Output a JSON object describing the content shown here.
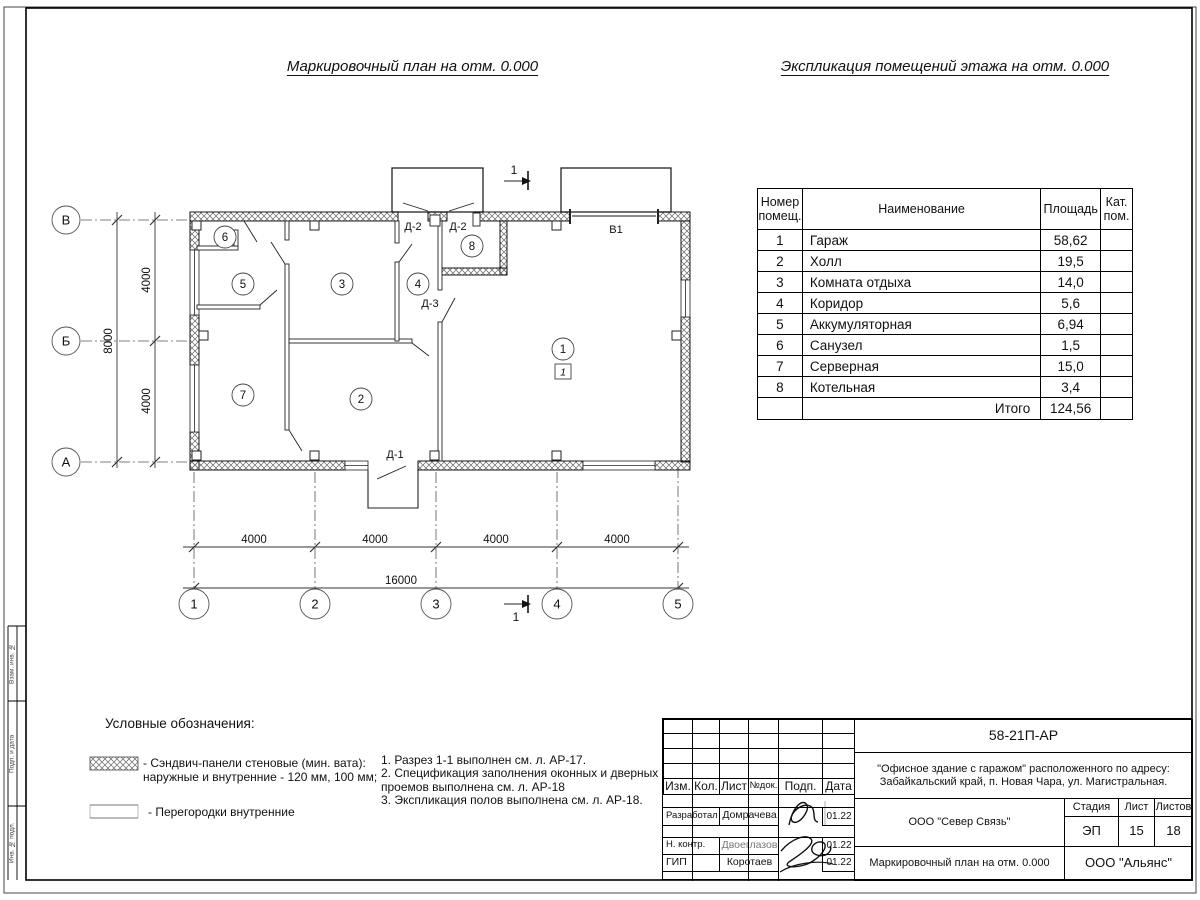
{
  "titles": {
    "plan": "Маркировочный план на отм. 0.000",
    "table": "Экспликация помещений этажа на отм. 0.000"
  },
  "plan": {
    "rooms": [
      "1",
      "2",
      "3",
      "4",
      "5",
      "6",
      "7",
      "8"
    ],
    "floor_mark": "1",
    "grid_cols": [
      "1",
      "2",
      "3",
      "4",
      "5"
    ],
    "grid_rows": [
      "В",
      "Б",
      "А"
    ],
    "dims_bottom": [
      "4000",
      "4000",
      "4000",
      "4000"
    ],
    "dim_total_bottom": "16000",
    "dims_left": [
      "4000",
      "4000"
    ],
    "dim_total_left": "8000",
    "doors": {
      "d2a": "Д-2",
      "d2b": "Д-2",
      "d3": "Д-3",
      "d1": "Д-1"
    },
    "gate": "В1",
    "section": "1"
  },
  "room_table": {
    "headers": [
      "Номер помещ.",
      "Наименование",
      "Площадь",
      "Кат. пом."
    ],
    "rows": [
      {
        "num": "1",
        "name": "Гараж",
        "area": "58,62",
        "cat": ""
      },
      {
        "num": "2",
        "name": "Холл",
        "area": "19,5",
        "cat": ""
      },
      {
        "num": "3",
        "name": "Комната отдыха",
        "area": "14,0",
        "cat": ""
      },
      {
        "num": "4",
        "name": "Коридор",
        "area": "5,6",
        "cat": ""
      },
      {
        "num": "5",
        "name": "Аккумуляторная",
        "area": "6,94",
        "cat": ""
      },
      {
        "num": "6",
        "name": "Санузел",
        "area": "1,5",
        "cat": ""
      },
      {
        "num": "7",
        "name": "Серверная",
        "area": "15,0",
        "cat": ""
      },
      {
        "num": "8",
        "name": "Котельная",
        "area": "3,4",
        "cat": ""
      }
    ],
    "total_label": "Итого",
    "total_value": "124,56"
  },
  "legend": {
    "title": "Условные обозначения:",
    "item1_line1": "- Сэндвич-панели стеновые (мин. вата):",
    "item1_line2": "наружные и внутренние - 120 мм, 100 мм;",
    "item2": "- Перегородки внутренние",
    "notes": "1. Разрез 1-1 выполнен см. л. АР-17.\n2. Спецификация заполнения оконных и дверных\nпроемов выполнена см. л. АР-18\n3. Экспликация полов выполнена см. л. АР-18."
  },
  "titleblock": {
    "doc_code": "58-21П-АР",
    "project_line1": "\"Офисное здание с гаражом\" расположенного по адресу:",
    "project_line2": "Забайкальский край, п. Новая Чара, ул. Магистральная.",
    "col_izm": "Изм.",
    "col_kol": "Кол.",
    "col_list": "Лист",
    "col_ndoc": "№док.",
    "col_podp": "Подп.",
    "col_data": "Дата",
    "row_developed": {
      "role": "Разработал",
      "name": "Домрачева",
      "date": "01.22"
    },
    "row_ncontrol": {
      "role": "Н. контр.",
      "name": "Двоеглазов",
      "date": "01.22"
    },
    "row_gip": {
      "role": "ГИП",
      "name": "Коротаев",
      "date": "01.22"
    },
    "org_design": "ООО \"Север Связь\"",
    "stage_label": "Стадия",
    "sheet_label": "Лист",
    "sheets_label": "Листов",
    "stage": "ЭП",
    "sheet": "15",
    "sheets": "18",
    "drawing_name": "Маркировочный план на отм. 0.000",
    "org_customer": "ООО \"Альянс\""
  },
  "side_stamp": {
    "labels": [
      "Взам. инв. №",
      "Подп. и дата",
      "Инв. № подл."
    ]
  }
}
